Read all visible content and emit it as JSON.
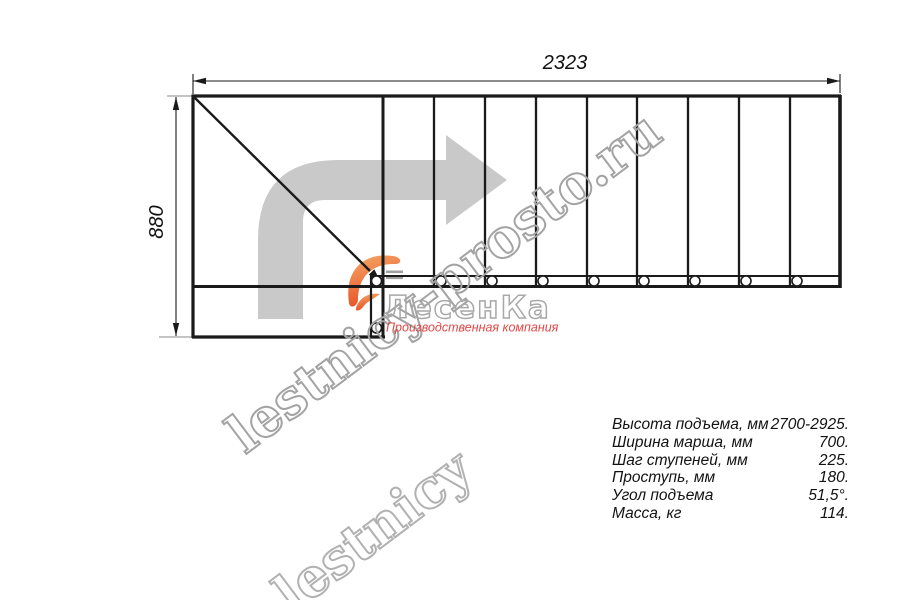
{
  "dimensions": {
    "width_mm": "2323",
    "height_mm": "880"
  },
  "watermark": {
    "main": "lestnicy-prosto.ru",
    "echo": "lestnicy"
  },
  "logo": {
    "name": "ЛесенКа",
    "tagline": "Производственная компания"
  },
  "specs": {
    "rows": [
      {
        "label": "Высота подъема, мм",
        "value": "2700-2925."
      },
      {
        "label": "Ширина марша, мм",
        "value": "700."
      },
      {
        "label": "Шаг ступеней, мм",
        "value": "225."
      },
      {
        "label": "Проступь, мм",
        "value": "180."
      },
      {
        "label": "Угол подъема",
        "value": "51,5°."
      },
      {
        "label": "Масса, кг",
        "value": "114."
      }
    ]
  },
  "colors": {
    "line": "#1a1a1a",
    "arrow_fill": "#c9c9c9",
    "watermark_stroke": "#a3a3a3",
    "tagline": "#e04747",
    "swoosh_top": "#f6a55f",
    "swoosh_bottom": "#e54a1d"
  }
}
